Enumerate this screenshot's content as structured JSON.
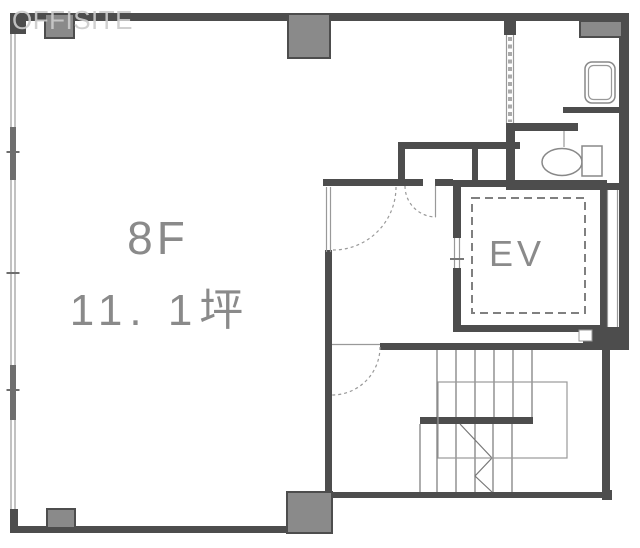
{
  "watermark": {
    "text": "OFFISITE"
  },
  "labels": {
    "floor": "8F",
    "area": "11. 1坪",
    "elevator": "EV"
  },
  "colors": {
    "wall": "#4d4d4d",
    "column": "#8a8a8a",
    "line": "#999999",
    "stair": "#777777",
    "label": "#8a8a8a",
    "watermark": "#cccccc",
    "bg": "#ffffff"
  }
}
